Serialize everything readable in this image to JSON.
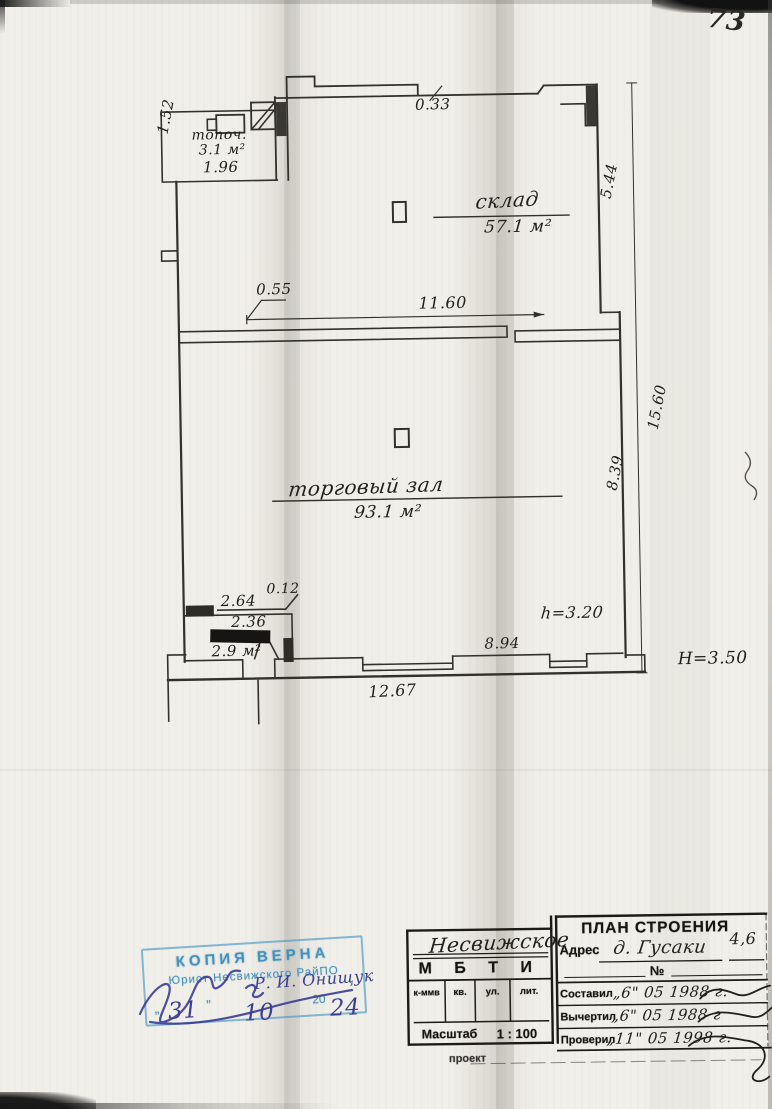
{
  "page": {
    "number": "73"
  },
  "plan": {
    "rooms": {
      "boiler_name": "топоч.",
      "boiler_area": "3.1 м²",
      "storage_name": "склад",
      "storage_area": "57.1 м²",
      "hall_name": "торговый зал",
      "hall_area": "93.1 м²",
      "vestibule_area": "2.9 м²"
    },
    "dims": {
      "d033": "0.33",
      "d152": "1.52",
      "d196": "1.96",
      "d544": "5.44",
      "d055": "0.55",
      "d1160": "11.60",
      "d1560": "15.60",
      "d839": "8.39",
      "d012": "0.12",
      "d264": "2.64",
      "d236": "2.36",
      "d894": "8.94",
      "d1267": "12.67",
      "h_int": "h=3.20",
      "h_ext": "Н=3.50"
    }
  },
  "stamp": {
    "title": "КОПИЯ ВЕРНА",
    "subtitle": "Юрист Несвижского РайПО",
    "open_quote": "„",
    "close_quote": "”",
    "century": "20",
    "day": "31",
    "month": "10",
    "year": "24",
    "signature_name": "Р. И. Онищук"
  },
  "titleblock": {
    "org_handwritten": "Несвижское",
    "org": "М Б Т И",
    "col1": "к-ммв",
    "col2": "кв.",
    "col3": "ул.",
    "col4": "лит.",
    "scale_label": "Масштаб",
    "scale_value": "1 : 100",
    "project_label": "проект",
    "doc_title": "ПЛАН СТРОЕНИЯ",
    "address_label": "Адрес",
    "address_value": "д. Гусаки",
    "address_num": "4,6",
    "no_label": "№",
    "rows": [
      {
        "label": "Составил",
        "date": "„6\" 05 1988 г."
      },
      {
        "label": "Вычертил",
        "date": "„6\" 05 1988 г"
      },
      {
        "label": "Проверил",
        "date": "„11\" 05 1998 г."
      }
    ]
  }
}
